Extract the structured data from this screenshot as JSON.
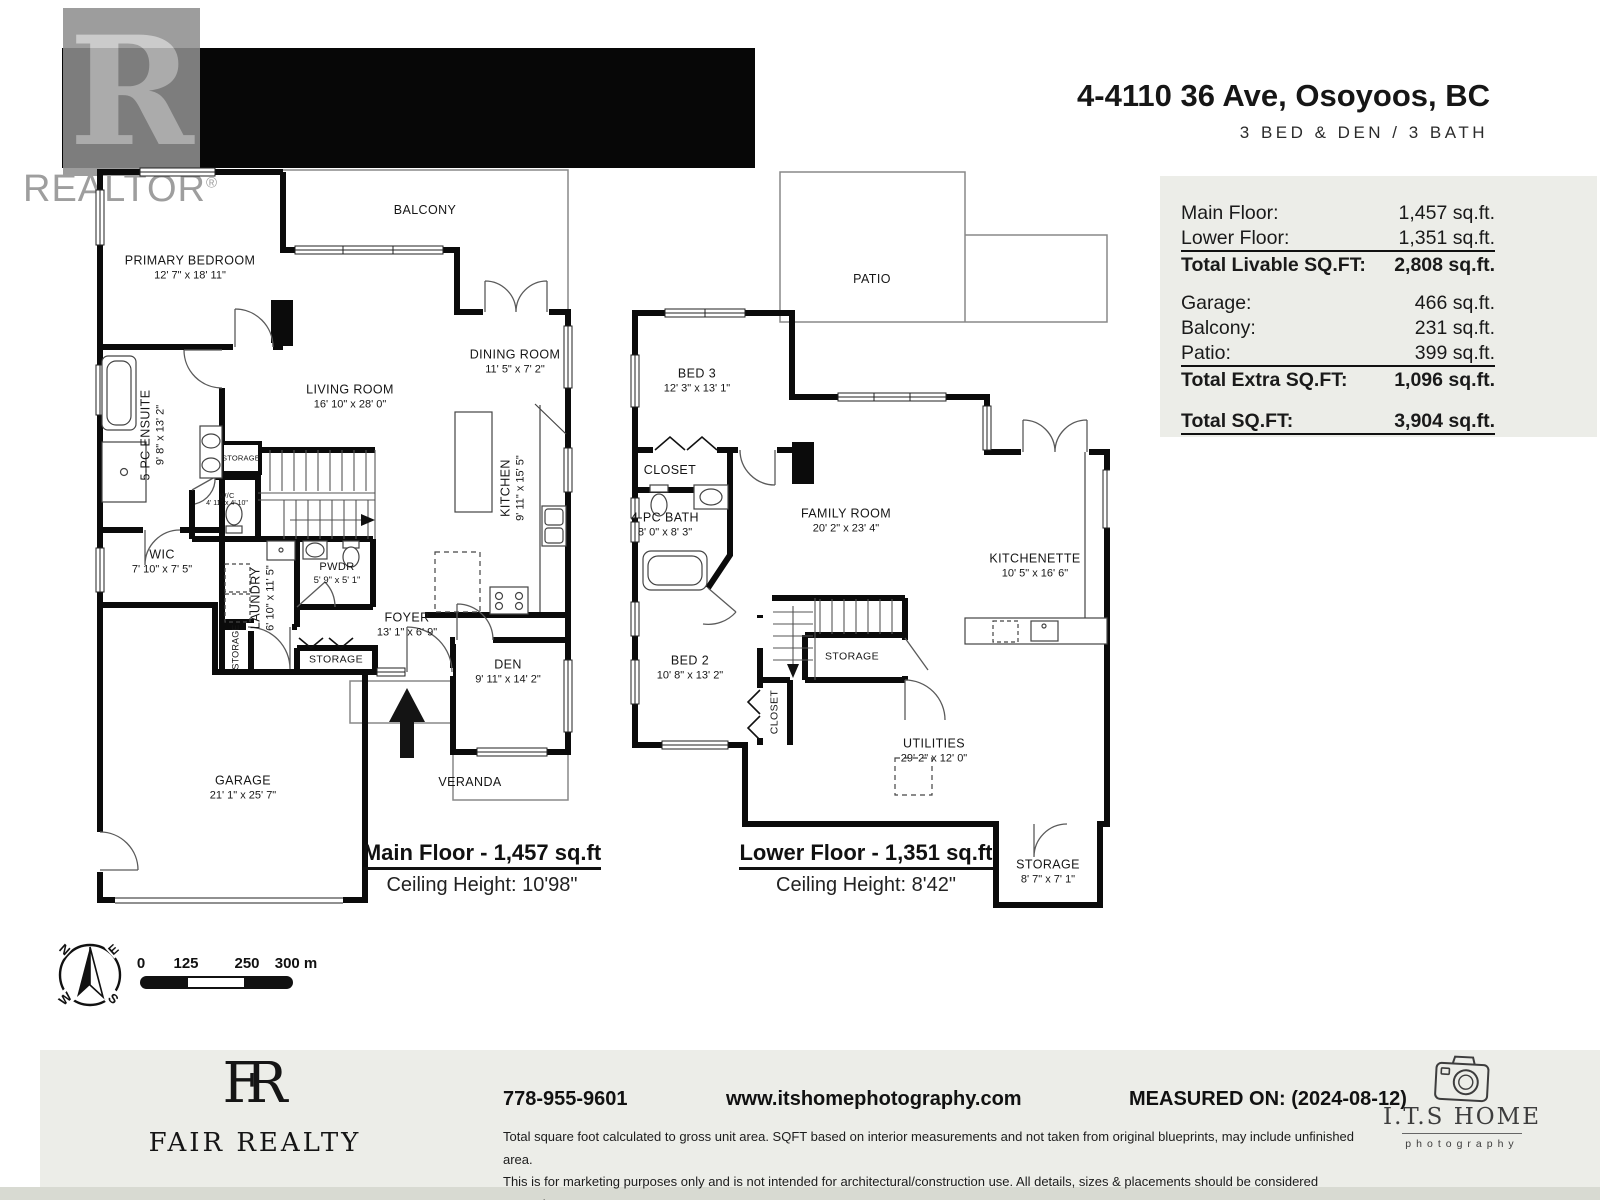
{
  "watermark": {
    "letter": "R",
    "brand": "REALTOR",
    "reg": "®"
  },
  "header": {
    "title": "4-4110 36 Ave, Osoyoos, BC",
    "subtitle": "3 BED & DEN / 3 BATH"
  },
  "area_table": {
    "main_floor_label": "Main Floor:",
    "main_floor_value": "1,457 sq.ft.",
    "lower_floor_label": "Lower Floor:",
    "lower_floor_value": "1,351 sq.ft.",
    "total_livable_label": "Total Livable SQ.FT:",
    "total_livable_value": "2,808 sq.ft.",
    "garage_label": "Garage:",
    "garage_value": "466 sq.ft.",
    "balcony_label": "Balcony:",
    "balcony_value": "231 sq.ft.",
    "patio_label": "Patio:",
    "patio_value": "399 sq.ft.",
    "total_extra_label": "Total Extra SQ.FT:",
    "total_extra_value": "1,096 sq.ft.",
    "total_label": "Total SQ.FT:",
    "total_value": "3,904 sq.ft."
  },
  "main_floor": {
    "caption": "Main Floor - 1,457 sq.ft",
    "ceiling": "Ceiling Height: 10'98\"",
    "rooms": {
      "balcony": {
        "name": "BALCONY"
      },
      "primary": {
        "name": "PRIMARY BEDROOM",
        "dims": "12' 7\" x 18' 11\""
      },
      "ensuite": {
        "name": "5-PC ENSUITE",
        "dims": "9' 8\" x 13' 2\""
      },
      "wic": {
        "name": "WIC",
        "dims": "7' 10\" x 7' 5\""
      },
      "living": {
        "name": "LIVING ROOM",
        "dims": "16' 10\" x 28' 0\""
      },
      "dining": {
        "name": "DINING ROOM",
        "dims": "11' 5\" x 7' 2\""
      },
      "kitchen": {
        "name": "KITCHEN",
        "dims": "9' 11\" x 15' 5\""
      },
      "wc": {
        "name": "W/C",
        "dims": "4' 11\" x 4' 10\""
      },
      "laundry": {
        "name": "LAUNDRY",
        "dims": "6' 10\" x 11' 5\""
      },
      "pwdr": {
        "name": "PWDR",
        "dims": "5' 9\" x 5' 1\""
      },
      "storage_a": {
        "name": "STORAGE"
      },
      "storage_b": {
        "name": "STORAGE"
      },
      "storage_c": {
        "name": "STORAGE"
      },
      "foyer": {
        "name": "FOYER",
        "dims": "13' 1\" x 6' 9\""
      },
      "den": {
        "name": "DEN",
        "dims": "9' 11\" x 14' 2\""
      },
      "garage": {
        "name": "GARAGE",
        "dims": "21' 1\" x 25' 7\""
      },
      "veranda": {
        "name": "VERANDA"
      }
    }
  },
  "lower_floor": {
    "caption": "Lower Floor - 1,351 sq.ft",
    "ceiling": "Ceiling Height: 8'42\"",
    "rooms": {
      "patio": {
        "name": "PATIO"
      },
      "bed3": {
        "name": "BED 3",
        "dims": "12' 3\" x 13' 1\""
      },
      "closet3": {
        "name": "CLOSET"
      },
      "bath": {
        "name": "4-PC BATH",
        "dims": "8' 0\" x 8' 3\""
      },
      "family": {
        "name": "FAMILY ROOM",
        "dims": "20' 2\" x 23' 4\""
      },
      "kitchenette": {
        "name": "KITCHENETTE",
        "dims": "10' 5\" x 16' 6\""
      },
      "bed2": {
        "name": "BED 2",
        "dims": "10' 8\" x 13' 2\""
      },
      "closet2": {
        "name": "CLOSET"
      },
      "storage_mid": {
        "name": "STORAGE"
      },
      "utilities": {
        "name": "UTILITIES",
        "dims": "29' 2\" x 12' 0\""
      },
      "storage_br": {
        "name": "STORAGE",
        "dims": "8' 7\" x 7' 1\""
      }
    }
  },
  "compass": {
    "n": "N",
    "e": "E",
    "s": "S",
    "w": "W"
  },
  "scale_bar": {
    "labels": [
      "0",
      "125",
      "250",
      "300 m"
    ]
  },
  "footer": {
    "monogram_f": "F",
    "monogram_r": "R",
    "brand_name": "FAIR REALTY",
    "phone": "778-955-9601",
    "website": "www.itshomephotography.com",
    "measured": "MEASURED ON: (2024-08-12)",
    "disclaimer_lines": [
      "Total square foot calculated to gross unit area. SQFT based on interior measurements and not taken from original blueprints, may include unfinished area.",
      "This is for marketing purposes only and is not intended for architectural/construction use. All details, sizes & placements should be considered approximate",
      "within +/- 2% tolerance."
    ],
    "photo_brand": "I.T.S HOME",
    "photo_sub": "photography"
  }
}
